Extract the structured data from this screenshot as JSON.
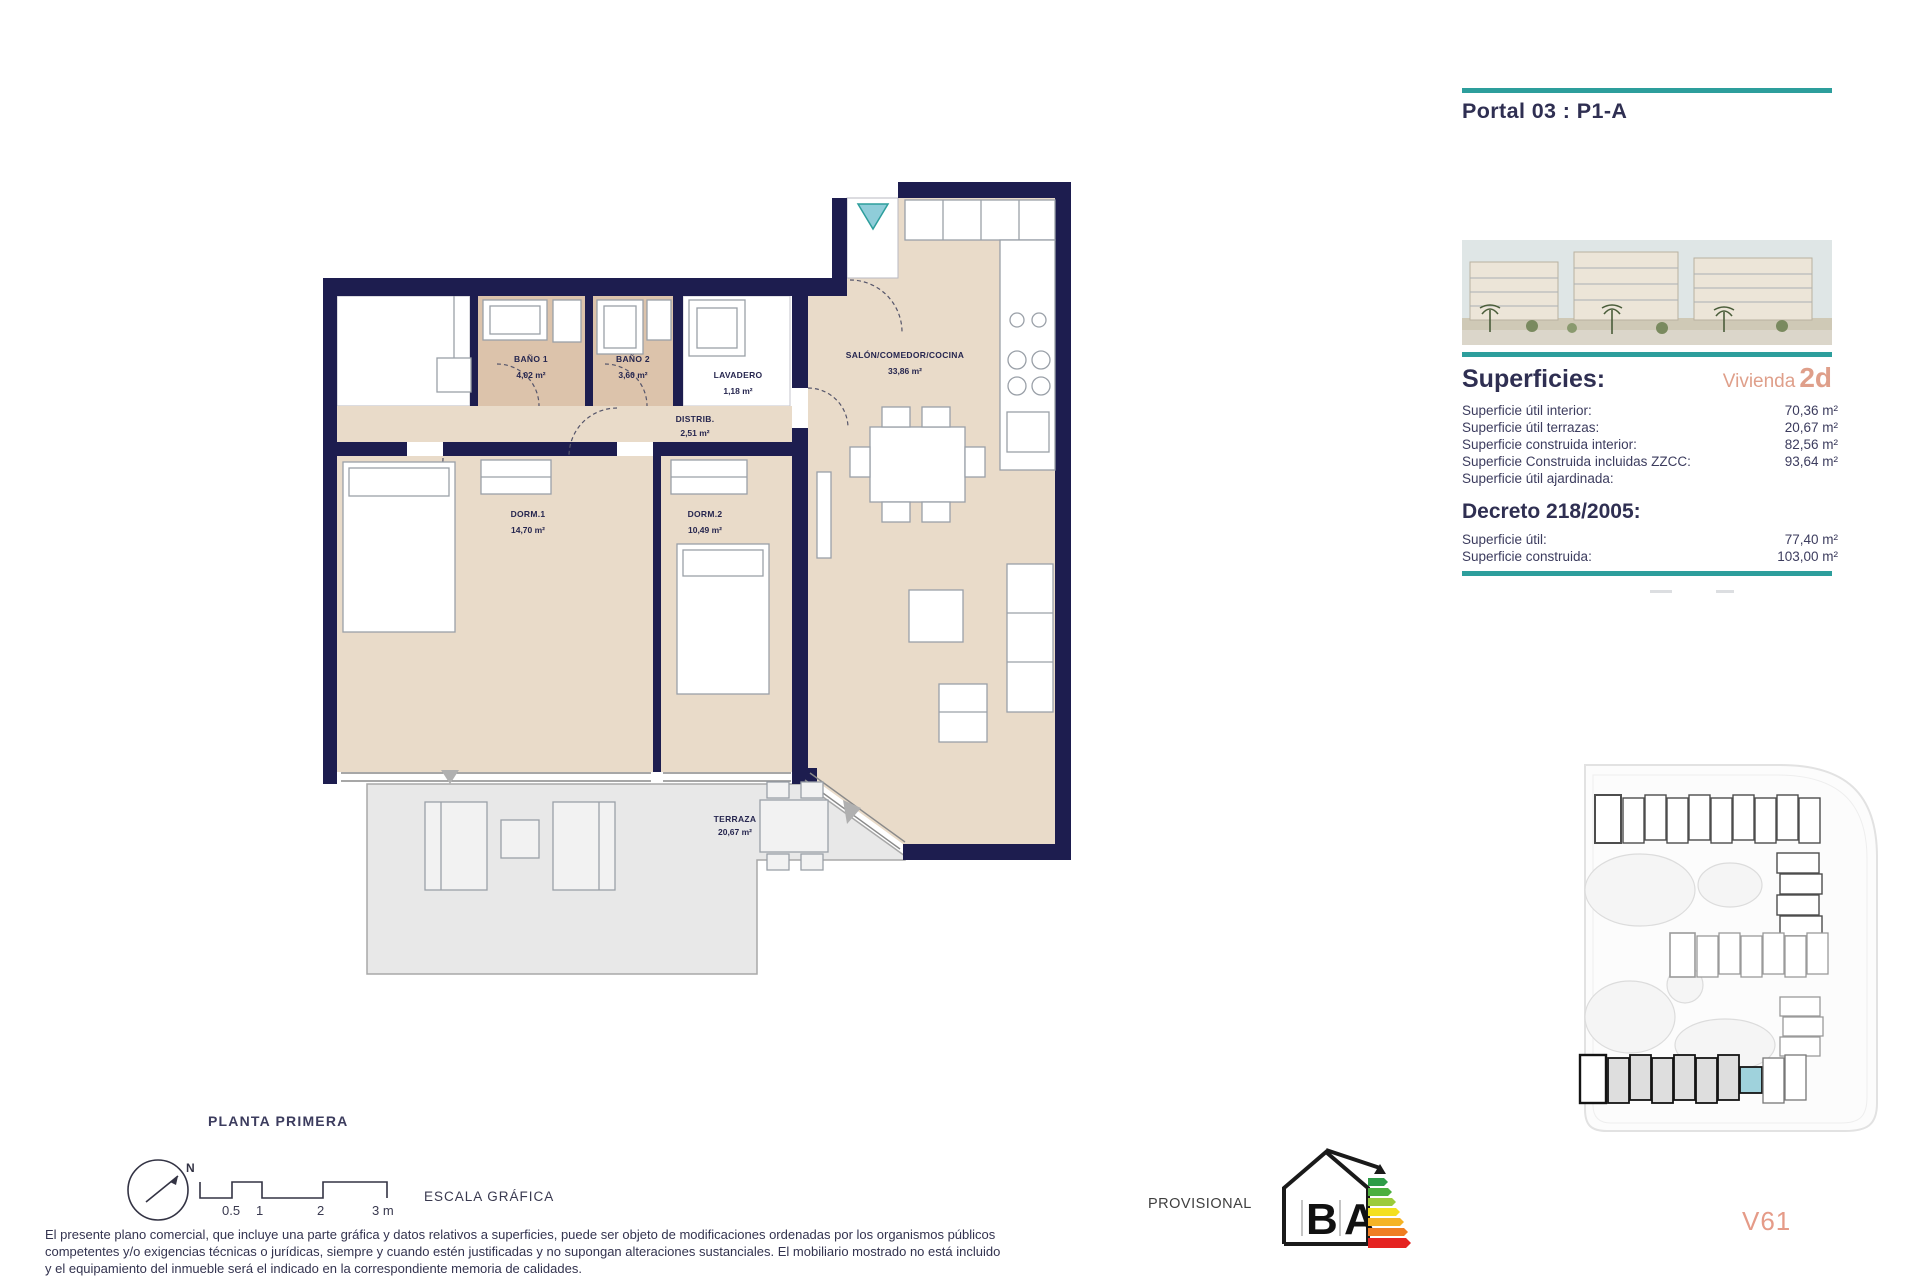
{
  "header": {
    "portal_title": "Portal 03 : P1-A"
  },
  "superficies": {
    "title": "Superficies:",
    "vivienda_label": "Vivienda",
    "vivienda_code": "2d",
    "rows": [
      {
        "label": "Superficie útil interior:",
        "value": "70,36 m²"
      },
      {
        "label": "Superficie útil terrazas:",
        "value": "20,67 m²"
      },
      {
        "label": "Superficie construida interior:",
        "value": "82,56 m²"
      },
      {
        "label": "Superficie Construida incluidas ZZCC:",
        "value": "93,64 m²"
      },
      {
        "label": "Superficie útil ajardinada:",
        "value": ""
      }
    ]
  },
  "decreto": {
    "title": "Decreto 218/2005:",
    "rows": [
      {
        "label": "Superficie útil:",
        "value": "77,40 m²"
      },
      {
        "label": "Superficie construida:",
        "value": "103,00 m²"
      }
    ]
  },
  "plan": {
    "rooms": [
      {
        "name": "BAÑO 1",
        "area": "4,02 m²"
      },
      {
        "name": "BAÑO 2",
        "area": "3,60 m²"
      },
      {
        "name": "LAVADERO",
        "area": "1,18 m²"
      },
      {
        "name": "SALÓN/COMEDOR/COCINA",
        "area": "33,86 m²"
      },
      {
        "name": "DISTRIB.",
        "area": "2,51 m²"
      },
      {
        "name": "DORM.1",
        "area": "14,70 m²"
      },
      {
        "name": "DORM.2",
        "area": "10,49 m²"
      },
      {
        "name": "TERRAZA",
        "area": "20,67 m²"
      }
    ]
  },
  "footer": {
    "floor_label": "PLANTA PRIMERA",
    "north_label": "N",
    "scale_ticks": [
      "0.5",
      "1",
      "2",
      "3 m"
    ],
    "scale_label": "ESCALA GRÁFICA",
    "provisional_label": "PROVISIONAL",
    "energy_letters": [
      "B",
      "A"
    ],
    "version_code": "V61",
    "disclaimer_lines": [
      "El presente plano comercial, que incluye una parte gráfica y datos relativos a superficies, puede ser objeto de modificaciones ordenadas por los organismos públicos",
      "competentes y/o exigencias técnicas o jurídicas, siempre y cuando estén justificadas y no supongan alteraciones sustanciales. El mobiliario mostrado no está incluido",
      "y el equipamiento del inmueble será el indicado en la correspondiente memoria de calidades."
    ]
  },
  "colors": {
    "accent_teal": "#2d9e9c",
    "accent_salmon": "#df9f8a",
    "wall_navy": "#1d1d4f",
    "floor_beige": "#e9dbc9",
    "floor_tan": "#dcc3ab",
    "terrace_gray": "#e8e8e8",
    "highlight_unit": "#9fd2dc"
  }
}
